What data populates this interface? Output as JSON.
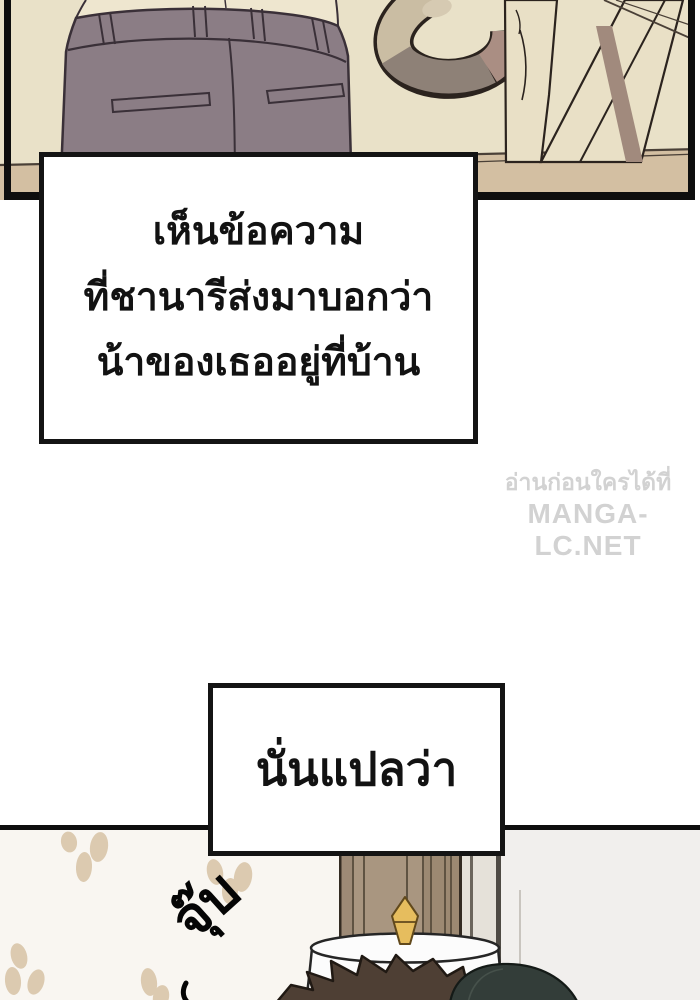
{
  "page": {
    "kind": "webtoon-page"
  },
  "narration_box_1": {
    "lines": [
      "เห็นข้อความ",
      "ที่ชานารีส่งมาบอกว่า",
      "น้าของเธออยู่ที่บ้าน"
    ]
  },
  "narration_box_2": {
    "text": "นั่นแปลว่า"
  },
  "watermark": {
    "line1": "อ่านก่อนใครได้ที่",
    "line2": "MANGA-LC.NET"
  },
  "bottom_panel": {
    "sfx": "จุ๊บ"
  },
  "colors": {
    "pageBg": "#ffffff",
    "boxBg": "#ffffff",
    "boxBorder": "#141414",
    "text": "#121212",
    "watermark": "#d2d2d2",
    "panelWall": "#e9e1c8",
    "floor": "#d3bfa2",
    "pants": "#8b7d85",
    "skin": "#eee6cf",
    "tailBeige": "#cabda3",
    "tailGray": "#8e8177",
    "tailMauve": "#aa8e83",
    "wallpaper": "#f9f6f1",
    "petal": "#dccab0",
    "column": "#a99680",
    "rightWall": "#f1efed",
    "tablecloth": "#fcfcfc",
    "vaseGold": "#e6bd5e",
    "hairBrown": "#4e3f34",
    "hairSlate": "#333d39",
    "inkOutline": "#0e0e0e"
  }
}
